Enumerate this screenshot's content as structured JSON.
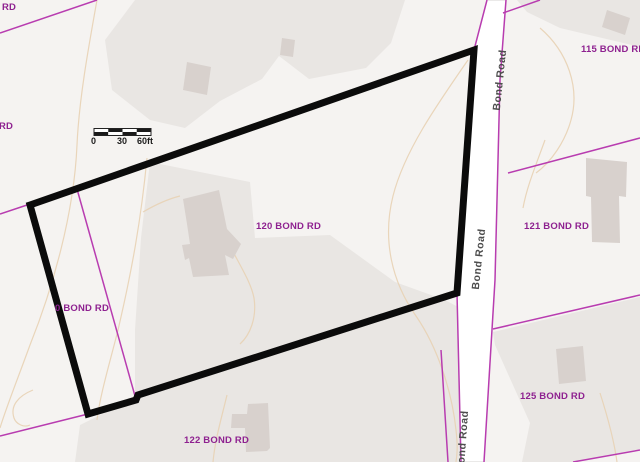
{
  "map": {
    "type": "parcel-map",
    "selected_parcel": "120 BOND RD",
    "labels": {
      "rd_topleft": "RD",
      "rd_left": "RD",
      "p115": "115 BOND RD",
      "p121": "121 BOND RD",
      "p125": "125 BOND RD",
      "p122": "122 BOND RD",
      "p120": "120 BOND RD",
      "p0": "0 BOND RD"
    },
    "road": {
      "name": "Bond Road"
    },
    "scale_bar": {
      "zero": "0",
      "thirty": "30",
      "sixty": "60ft"
    },
    "colors": {
      "bg": "#f5f3f1",
      "terrain": "#e9e6e3",
      "contour": "#e8d2b4",
      "parcel-line": "#b83cb0",
      "building": "#d8d1cd",
      "highlight": "#0b0b0b",
      "label": "#8e2190",
      "road-label": "#4d4d4d"
    }
  }
}
